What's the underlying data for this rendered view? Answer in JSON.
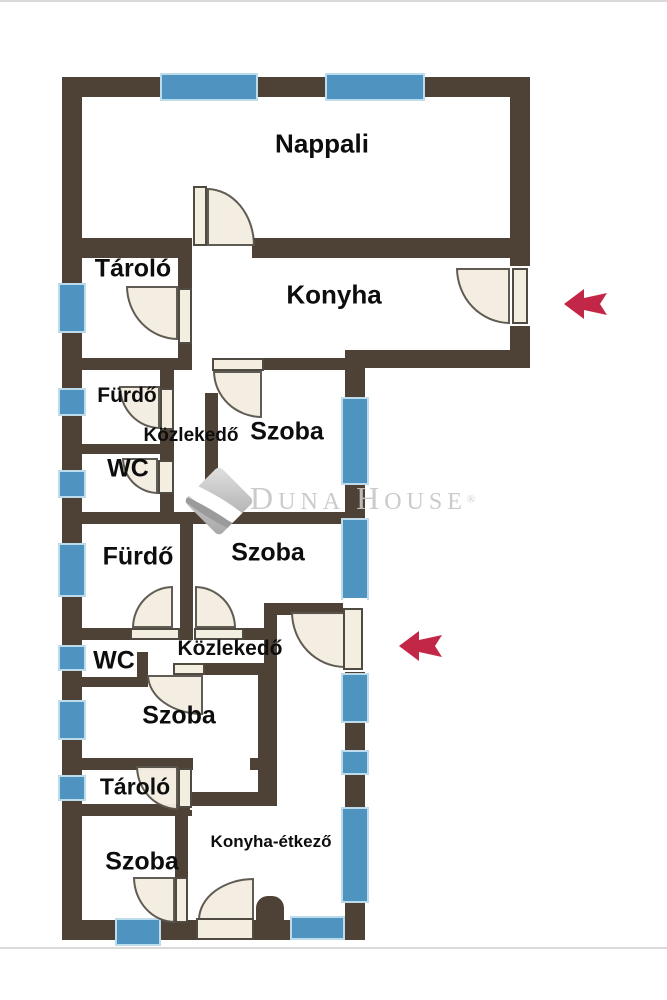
{
  "rooms": [
    {
      "label": "Nappali"
    },
    {
      "label": "Tároló"
    },
    {
      "label": "Konyha"
    },
    {
      "label": "Fürdő"
    },
    {
      "label": "Közlekedő"
    },
    {
      "label": "Szoba"
    },
    {
      "label": "WC"
    },
    {
      "label": "Fürdő"
    },
    {
      "label": "Szoba"
    },
    {
      "label": "Közlekedő"
    },
    {
      "label": "WC"
    },
    {
      "label": "Szoba"
    },
    {
      "label": "Tároló"
    },
    {
      "label": "Szoba"
    },
    {
      "label": "Konyha-étkező"
    }
  ],
  "watermark": {
    "part1": "D",
    "part2": "UNA",
    "part3": "H",
    "part4": "OUSE",
    "registered": "®"
  },
  "entrance_arrows": {
    "count": 2,
    "direction": "left"
  },
  "colors": {
    "wall": "#4e4237",
    "window": "#4f94c0",
    "window_frame": "#bcdcec",
    "door": "#f4eee1",
    "arrow": "#c32748",
    "watermark": "#c7c7c7"
  }
}
